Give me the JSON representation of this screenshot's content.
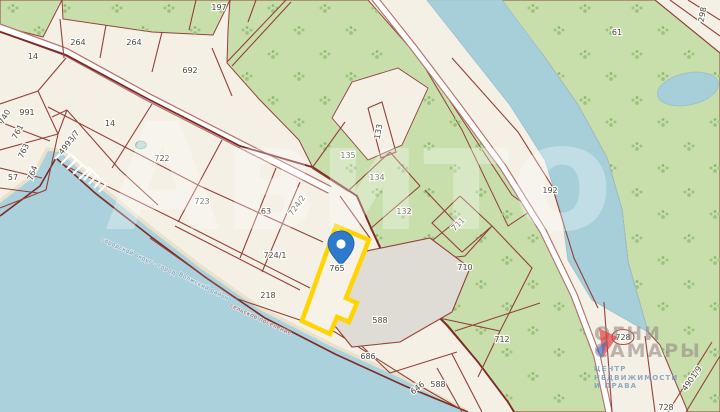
{
  "watermark_brand": "Авито",
  "logo": {
    "title_line1": "ОГНИ",
    "title_line2": "САМАРЫ",
    "subtitle_line1": "ЦЕНТР",
    "subtitle_line2": "НЕДВИЖИМОСТИ",
    "subtitle_line3": "И ПРАВА"
  },
  "highlight": {
    "parcel_number": "765"
  },
  "admin_boundary_labels": [
    {
      "text": "городской округ - город",
      "x": 138,
      "y": 258,
      "rot": 25,
      "color": "#7d93ab"
    },
    {
      "text": "Волжский район",
      "x": 203,
      "y": 288,
      "rot": 27,
      "color": "#7d93ab"
    },
    {
      "text": "сельское поселение",
      "x": 260,
      "y": 321,
      "rot": 25,
      "color": "#a2564c"
    }
  ],
  "parcel_labels": [
    {
      "id": "197",
      "x": 219,
      "y": 10,
      "rot": 0
    },
    {
      "id": "264",
      "x": 78,
      "y": 45,
      "rot": 0
    },
    {
      "id": "264",
      "x": 134,
      "y": 45,
      "rot": 0
    },
    {
      "id": "14",
      "x": 33,
      "y": 59,
      "rot": 0
    },
    {
      "id": "692",
      "x": 190,
      "y": 73,
      "rot": 0
    },
    {
      "id": "14",
      "x": 110,
      "y": 126,
      "rot": 0
    },
    {
      "id": "991",
      "x": 27,
      "y": 115,
      "rot": 0
    },
    {
      "id": "740",
      "x": 7,
      "y": 118,
      "rot": -62
    },
    {
      "id": "761",
      "x": 20,
      "y": 133,
      "rot": -62
    },
    {
      "id": "763",
      "x": 26,
      "y": 152,
      "rot": -65
    },
    {
      "id": "764",
      "x": 35,
      "y": 174,
      "rot": -70
    },
    {
      "id": "57",
      "x": 13,
      "y": 180,
      "rot": 0
    },
    {
      "id": "4993/7",
      "x": 71,
      "y": 144,
      "rot": -52
    },
    {
      "id": "722",
      "x": 162,
      "y": 161,
      "rot": 0
    },
    {
      "id": "723",
      "x": 202,
      "y": 204,
      "rot": 0
    },
    {
      "id": "63",
      "x": 266,
      "y": 214,
      "rot": 0
    },
    {
      "id": "724/2",
      "x": 299,
      "y": 207,
      "rot": -55
    },
    {
      "id": "724/1",
      "x": 275,
      "y": 258,
      "rot": 0
    },
    {
      "id": "218",
      "x": 268,
      "y": 298,
      "rot": 0
    },
    {
      "id": "765",
      "x": 337,
      "y": 271,
      "rot": 0
    },
    {
      "id": "588",
      "x": 380,
      "y": 323,
      "rot": 0
    },
    {
      "id": "686",
      "x": 368,
      "y": 359,
      "rot": 0
    },
    {
      "id": "646",
      "x": 419,
      "y": 390,
      "rot": -38
    },
    {
      "id": "588",
      "x": 438,
      "y": 387,
      "rot": 0
    },
    {
      "id": "133",
      "x": 381,
      "y": 132,
      "rot": -80
    },
    {
      "id": "135",
      "x": 348,
      "y": 158,
      "rot": 0
    },
    {
      "id": "134",
      "x": 377,
      "y": 180,
      "rot": 0
    },
    {
      "id": "132",
      "x": 404,
      "y": 214,
      "rot": 0
    },
    {
      "id": "711",
      "x": 460,
      "y": 226,
      "rot": -45
    },
    {
      "id": "710",
      "x": 465,
      "y": 270,
      "rot": 0
    },
    {
      "id": "712",
      "x": 502,
      "y": 342,
      "rot": 0
    },
    {
      "id": "192",
      "x": 550,
      "y": 193,
      "rot": 0
    },
    {
      "id": "61",
      "x": 617,
      "y": 35,
      "rot": 0
    },
    {
      "id": "298",
      "x": 705,
      "y": 15,
      "rot": -80
    },
    {
      "id": "728",
      "x": 623,
      "y": 340,
      "rot": 0,
      "circled": true
    },
    {
      "id": "4901/9",
      "x": 694,
      "y": 380,
      "rot": -55
    },
    {
      "id": "728",
      "x": 666,
      "y": 410,
      "rot": 0
    }
  ],
  "colors": {
    "land": "#f4f0e5",
    "forest": "#c8dfac",
    "water": "#abd2dc",
    "parcel_line": "#93413a",
    "municipal_line": "#7c2a26",
    "highlight_outline": "#ffd400",
    "pin": "#2e7bcc",
    "industrial_gray": "#dfdcd5"
  }
}
